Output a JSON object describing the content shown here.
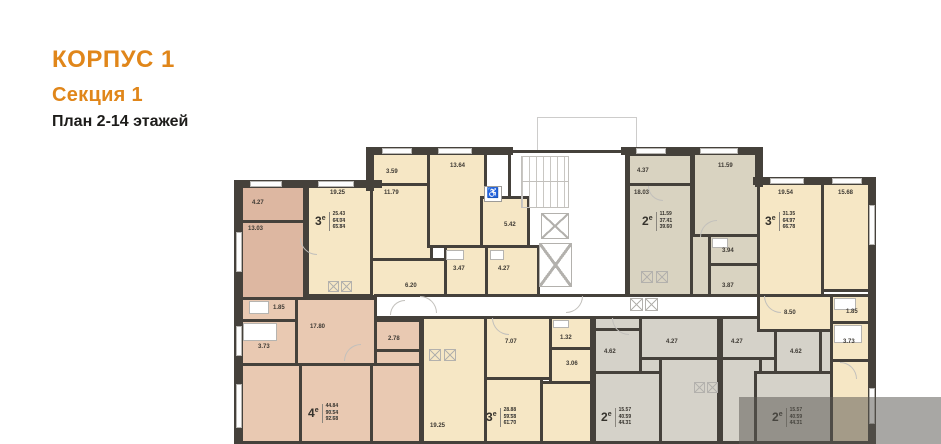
{
  "header": {
    "building": "КОРПУС 1",
    "section": "Секция 1",
    "plan": "План 2-14 этажей"
  },
  "colors": {
    "accent_orange": "#e0861a",
    "wall_dark": "#45413b",
    "fill_pink_dark": "#ddb7a1",
    "fill_pink": "#e9c9b2",
    "fill_cream": "#f6e7c5",
    "fill_taupe": "#d9d3c1",
    "fill_gray": "#d5d2c9",
    "overlay_gray": "rgba(88,86,80,0.52)"
  },
  "icons": {
    "accessible": "♿"
  },
  "apartments": {
    "apt4": {
      "type": "4",
      "sup": "е",
      "areas": [
        "44.84",
        "90.54",
        "92.68"
      ]
    },
    "apt3tl": {
      "type": "3",
      "sup": "е",
      "areas": [
        "25.43",
        "64.04",
        "65.84"
      ]
    },
    "apt2t": {
      "type": "2",
      "sup": "е",
      "areas": [
        "11.59",
        "37.41",
        "39.60"
      ]
    },
    "apt3tr": {
      "type": "3",
      "sup": "е",
      "areas": [
        "31.35",
        "64.97",
        "66.78"
      ]
    },
    "apt3b": {
      "type": "3",
      "sup": "е",
      "areas": [
        "28.88",
        "59.58",
        "61.70"
      ]
    },
    "apt2bl": {
      "type": "2",
      "sup": "е",
      "areas": [
        "15.57",
        "40.59",
        "44.31"
      ]
    },
    "apt2br": {
      "type": "2",
      "sup": "е",
      "areas": [
        "15.57",
        "40.59",
        "44.31"
      ]
    }
  },
  "rooms": {
    "p427": "4.27",
    "p1303": "13.03",
    "p185": "1.85",
    "p373": "3.73",
    "p1780": "17.80",
    "p278": "2.78",
    "c1925": "19.25",
    "c359": "3.59",
    "c1179": "11.79",
    "c620": "6.20",
    "c1364": "13.64",
    "c347": "3.47",
    "c427": "4.27",
    "c542": "5.42",
    "t437": "4.37",
    "t1803": "18.03",
    "t1159": "11.59",
    "t394": "3.94",
    "t387": "3.87",
    "q1954": "19.54",
    "q1568": "15.68",
    "q850": "8.50",
    "q185": "1.85",
    "q373": "3.73",
    "b1925": "19.25",
    "b707": "7.07",
    "b132": "1.32",
    "b306": "3.06",
    "g462": "4.62",
    "g427": "4.27",
    "h427": "4.27",
    "h462": "4.62"
  }
}
